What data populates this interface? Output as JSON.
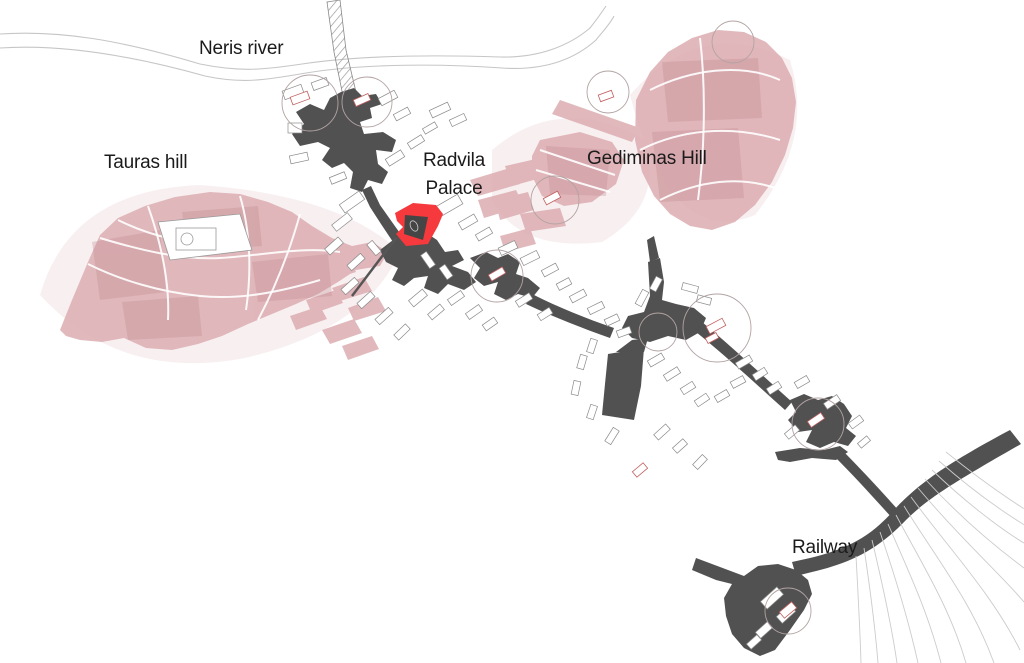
{
  "labels": {
    "neris_river": "Neris river",
    "tauras_hill": "Tauras hill",
    "radvila_line1": "Radvila",
    "radvila_line2": "Palace",
    "gediminas_hill": "Gediminas Hill",
    "railway": "Railway"
  },
  "colors": {
    "background": "#ffffff",
    "route": "#515151",
    "hill": "#dcadb1",
    "hill_shade": "#c08a8e",
    "hill_wash": "#f0dcde",
    "highlight_red": "#f5393d",
    "river": "#c6c6c6",
    "building_outline": "#8a8a8a",
    "landmark_outline": "#c2605f",
    "node_circle": "#b3a3a3",
    "track": "#cccccc",
    "label_text": "#1b1b1b"
  },
  "map": {
    "features": [
      {
        "name": "neris-river",
        "label": "Neris river"
      },
      {
        "name": "tauras-hill",
        "label": "Tauras hill"
      },
      {
        "name": "radvila-palace",
        "label": "Radvila Palace"
      },
      {
        "name": "gediminas-hill",
        "label": "Gediminas Hill"
      },
      {
        "name": "railway",
        "label": "Railway"
      }
    ]
  }
}
